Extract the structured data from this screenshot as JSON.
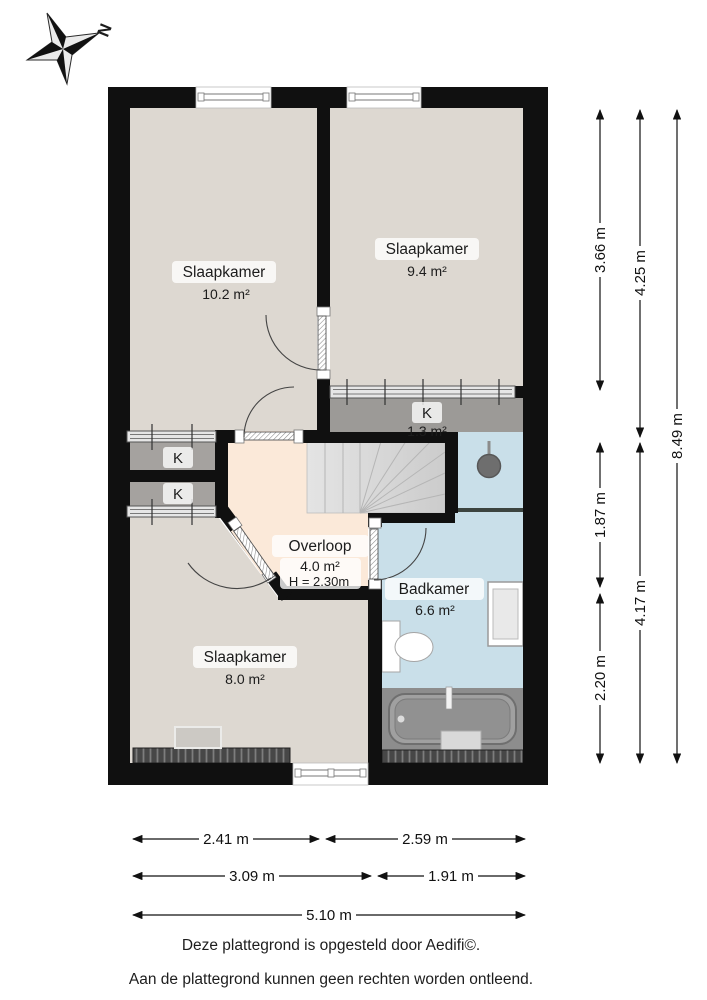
{
  "compass": {
    "label": "N"
  },
  "rooms": {
    "bedroom_left": {
      "label": "Slaapkamer",
      "area": "10.2 m²"
    },
    "bedroom_right": {
      "label": "Slaapkamer",
      "area": "9.4 m²"
    },
    "closet_main": {
      "label": "K",
      "area": "1.3 m²"
    },
    "closet_upper": {
      "label": "K"
    },
    "closet_lower": {
      "label": "K"
    },
    "landing": {
      "label": "Overloop",
      "area": "4.0 m²",
      "ceiling_height": "H = 2.30m"
    },
    "bathroom": {
      "label": "Badkamer",
      "area": "6.6 m²"
    },
    "bedroom_bottom": {
      "label": "Slaapkamer",
      "area": "8.0 m²"
    }
  },
  "dimensions": {
    "right_inner_top": "3.66 m",
    "right_mid_top": "4.25 m",
    "right_outer": "8.49 m",
    "right_inner_middle": "1.87 m",
    "right_mid_bottom": "4.17 m",
    "right_inner_bottom": "2.20 m",
    "bottom_row1_left": "2.41 m",
    "bottom_row1_right": "2.59 m",
    "bottom_row2_left": "3.09 m",
    "bottom_row2_right": "1.91 m",
    "bottom_total": "5.10 m"
  },
  "footer": {
    "credit": "Deze plattegrond is opgesteld door Aedifi©.",
    "disclaimer": "Aan de plattegrond kunnen geen rechten worden ontleend."
  },
  "colors": {
    "wall": "#101010",
    "floor": "#ddd8d1",
    "landing": "#fbe9d9",
    "bathroom": "#c9dfe9",
    "closet": "#a5a29f",
    "closet_dark": "#9c9a97",
    "stairs": "#d8d8d8"
  }
}
